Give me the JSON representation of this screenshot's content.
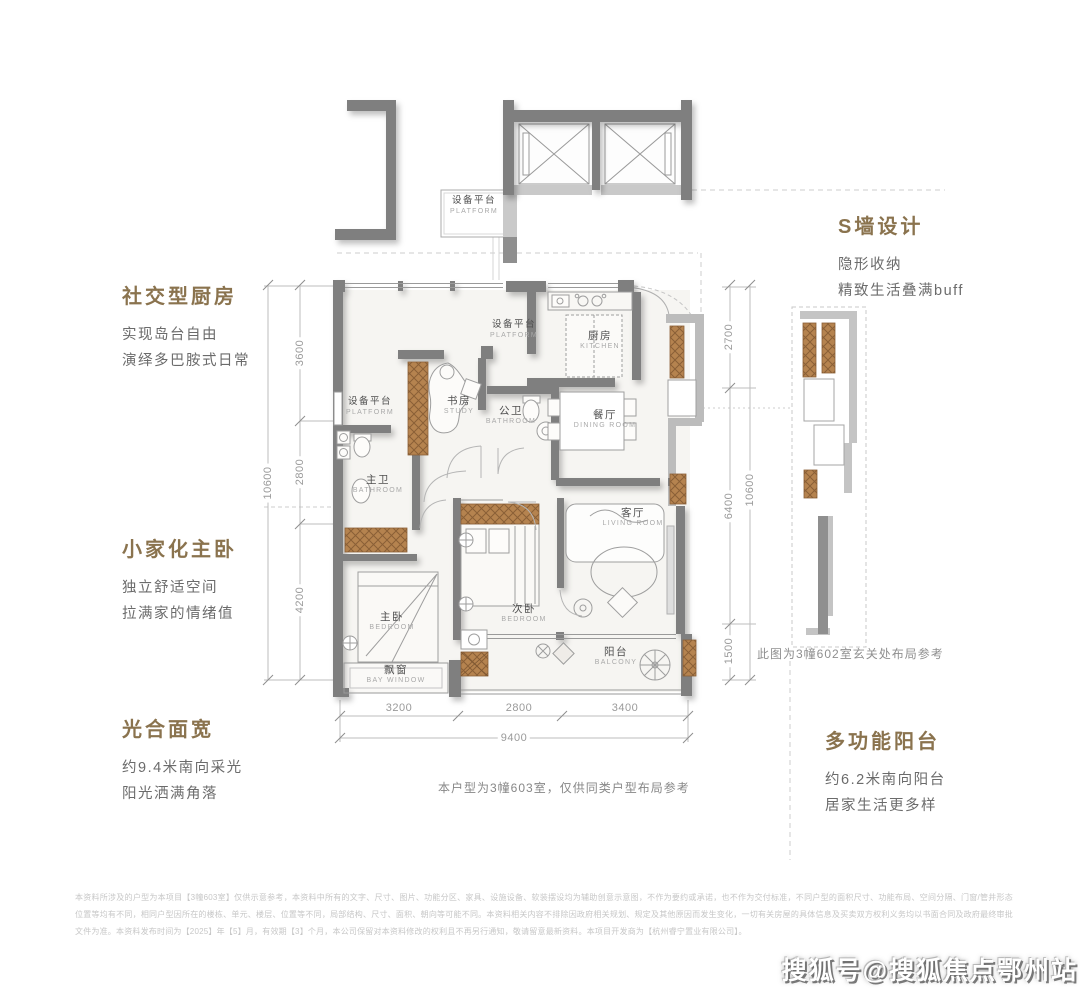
{
  "colors": {
    "accent_title": "#8a734e",
    "body_text": "#6b6b6b",
    "wall_dark": "#7f7f7f",
    "wall_light": "#c3c3c3",
    "wood": "#b5834f",
    "dim_text": "#9a9a9a",
    "disclaimer_text": "#c7c7c7"
  },
  "callouts": {
    "kitchen": {
      "title": "社交型厨房",
      "line1": "实现岛台自由",
      "line2": "演绎多巴胺式日常"
    },
    "master": {
      "title": "小家化主卧",
      "line1": "独立舒适空间",
      "line2": "拉满家的情绪值"
    },
    "width": {
      "title": "光合面宽",
      "line1": "约9.4米南向采光",
      "line2": "阳光洒满角落"
    },
    "swall": {
      "title": "S墙设计",
      "line1": "隐形收纳",
      "line2": "精致生活叠满buff"
    },
    "balcony": {
      "title": "多功能阳台",
      "line1": "约6.2米南向阳台",
      "line2": "居家生活更多样"
    }
  },
  "rooms": {
    "platform_top": {
      "cn": "设备平台",
      "en": "PLATFORM"
    },
    "kitchen": {
      "cn": "厨房",
      "en": "KITCHEN"
    },
    "platform_mid": {
      "cn": "设备平台",
      "en": "PLATFORM"
    },
    "platform_left": {
      "cn": "设备平台",
      "en": "PLATFORM"
    },
    "study": {
      "cn": "书房",
      "en": "STUDY"
    },
    "guest_bath": {
      "cn": "公卫",
      "en": "BATHROOM"
    },
    "dining": {
      "cn": "餐厅",
      "en": "DINING ROOM"
    },
    "master_bath": {
      "cn": "主卫",
      "en": "BATHROOM"
    },
    "living": {
      "cn": "客厅",
      "en": "LIVING ROOM"
    },
    "master_bed": {
      "cn": "主卧",
      "en": "BEDROOM"
    },
    "second_bed": {
      "cn": "次卧",
      "en": "BEDROOM"
    },
    "balcony": {
      "cn": "阳台",
      "en": "BALCONY"
    },
    "bay_window": {
      "cn": "飘窗",
      "en": "BAY WINDOW"
    }
  },
  "dimensions": {
    "left": {
      "segments": [
        "3600",
        "2800",
        "4200"
      ],
      "total": "10600"
    },
    "right": {
      "segments": [
        "2700",
        "6400",
        "1500"
      ],
      "total": "10600"
    },
    "bottom": {
      "segments": [
        "3200",
        "2800",
        "3400"
      ],
      "total": "9400"
    }
  },
  "notes": {
    "entry": "此图为3幢602室玄关处布局参考",
    "unit": "本户型为3幢603室，仅供同类户型布局参考"
  },
  "disclaimer": {
    "text": "本资料所涉及的户型为本项目【3幢603室】仅供示意参考，本资料中所有的文字、尺寸、图片、功能分区、家具、设施设备、软装摆设均为辅助创意示意图，不作为要约或承诺，也不作为交付标准，不同户型的面积尺寸、功能布局、空间分隔、门窗/管井形态位置等均有不同，相同户型因所在的楼栋、单元、楼层、位置等不同，局部结构、尺寸、面积、朝向等可能不同。本资料相关内容不排除因政府相关规划、规定及其他原因而发生变化，一切有关房屋的具体信息及买卖双方权利义务均以书面合同及政府最终审批文件为准。本资料发布时间为【2025】年【5】月，有效期【3】个月，本公司保留对本资料修改的权利且不再另行通知，敬请留意最新资料。本项目开发商为【杭州睿宁置业有限公司】。"
  },
  "watermark": "搜狐号@搜狐焦点鄂州站"
}
